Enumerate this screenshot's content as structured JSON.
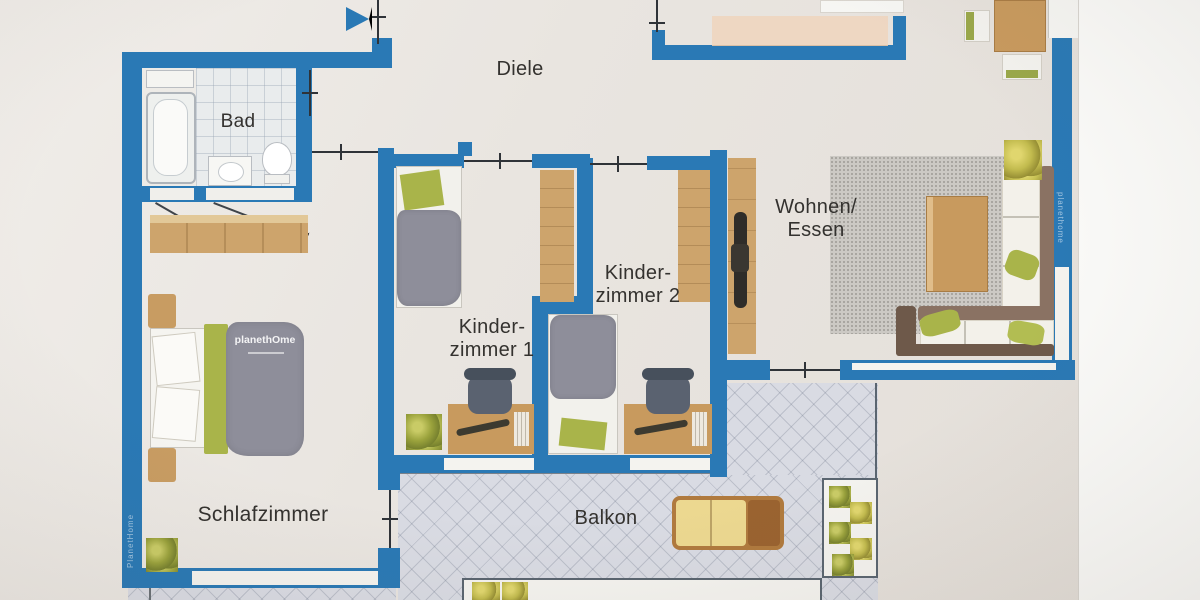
{
  "rooms": {
    "diele": {
      "label": "Diele"
    },
    "bad": {
      "label": "Bad"
    },
    "kz1": {
      "line1": "Kinder-",
      "line2": "zimmer 1"
    },
    "kz2": {
      "line1": "Kinder-",
      "line2": "zimmer 2"
    },
    "wohnen": {
      "line1": "Wohnen/",
      "line2": "Essen"
    },
    "schlaf": {
      "label": "Schlafzimmer"
    },
    "balkon": {
      "label": "Balkon"
    }
  },
  "watermarks": {
    "bed_logo": "planethOme",
    "left_wall": "PlanetHome",
    "right_wall": "planethome"
  },
  "icons": {
    "entrance_arrow": "right-pointing-triangle"
  },
  "furniture": {
    "bad": [
      "bathtub",
      "sink",
      "toilet",
      "cabinet"
    ],
    "schlafzimmer": [
      "wardrobe",
      "double-bed",
      "nightstands",
      "plant"
    ],
    "kinderzimmer1": [
      "single-bed",
      "wardrobe",
      "desk",
      "chair",
      "plant"
    ],
    "kinderzimmer2": [
      "single-bed",
      "wardrobe",
      "desk",
      "chair"
    ],
    "wohnen_essen": [
      "dining-table",
      "chairs",
      "kitchen-counter",
      "tv-cabinet",
      "tv",
      "rug",
      "coffee-table",
      "corner-sofa",
      "plant"
    ],
    "balkon": [
      "sun-lounger",
      "planter-boxes",
      "plants"
    ]
  },
  "colors": {
    "wall": "#2a79b5",
    "paper": "#e9e5e0",
    "wood": "#cda46c",
    "duvet_gray": "#8e8e9a",
    "accent_green": "#a9b44a",
    "balcony_tile": "#d9dbe3",
    "lounger_pad": "#ecd890",
    "label_text": "#34322f"
  }
}
